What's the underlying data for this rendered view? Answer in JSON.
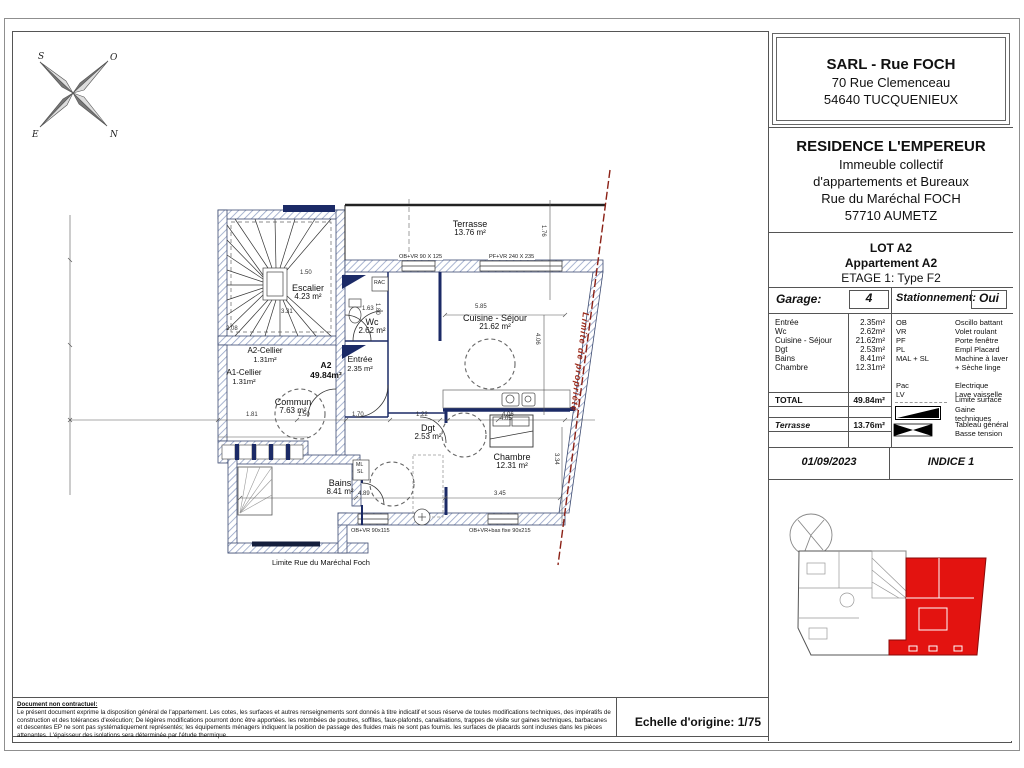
{
  "colors": {
    "key_red": "#e31310",
    "property_line": "#8b2015",
    "wall_hatch": "#94a3c6",
    "navy": "#1b2a66"
  },
  "compass": {
    "s": "S",
    "o": "O",
    "e": "E",
    "n": "N"
  },
  "title_block": {
    "company": {
      "name": "SARL - Rue FOCH",
      "address1": "70 Rue Clemenceau",
      "address2": "54640 TUCQUENIEUX"
    },
    "project": {
      "name": "RESIDENCE L'EMPEREUR",
      "line1": "Immeuble collectif",
      "line2": "d'appartements et Bureaux",
      "line3": "Rue du Maréchal FOCH",
      "line4": "57710 AUMETZ"
    },
    "lot": {
      "line1": "LOT A2",
      "line2": "Appartement  A2",
      "line3": "ETAGE 1: Type F2"
    },
    "garage": {
      "label": "Garage:",
      "value": "4"
    },
    "stationnement": {
      "label": "Stationnement:",
      "value": "Oui"
    },
    "rooms": [
      {
        "name": "Entrée",
        "area": "2.35m²"
      },
      {
        "name": "Wc",
        "area": "2.62m²"
      },
      {
        "name": "Cuisine - Séjour",
        "area": "21.62m²"
      },
      {
        "name": "Dgt",
        "area": "2.53m²"
      },
      {
        "name": "Bains",
        "area": "8.41m²"
      },
      {
        "name": "Chambre",
        "area": "12.31m²"
      }
    ],
    "legend": [
      {
        "abbr": "OB",
        "meaning": "Oscillo battant"
      },
      {
        "abbr": "VR",
        "meaning": "Volet roulant"
      },
      {
        "abbr": "PF",
        "meaning": "Porte fenêtre"
      },
      {
        "abbr": "PL",
        "meaning": "Empl Placard"
      },
      {
        "abbr": "MAL + SL",
        "meaning": "Machine à laver",
        "meaning2": "+ Sèche linge"
      },
      {
        "abbr": "Pac",
        "meaning": "Electrique"
      },
      {
        "abbr": "LV",
        "meaning": "Lave vaisselle"
      }
    ],
    "legend_symbols": {
      "limite": "Limite surface",
      "gaine": "Gaine techniques",
      "tableau_1": "Tableau général",
      "tableau_2": "Basse tension"
    },
    "total": {
      "label": "TOTAL",
      "value": "49.84m²"
    },
    "terrasse": {
      "label": "Terrasse",
      "value": "13.76m²"
    },
    "date": "01/09/2023",
    "indice": "INDICE 1"
  },
  "plan": {
    "rooms": [
      {
        "name": "Terrasse",
        "area": "13.76 m²"
      },
      {
        "name": "Escalier",
        "area": "4.23 m²"
      },
      {
        "name": "Wc",
        "area": "2.62 m²"
      },
      {
        "name": "Cuisine - Séjour",
        "area": "21.62 m²"
      },
      {
        "name": "A2-Cellier",
        "area": "1.31m²"
      },
      {
        "name": "A1-Cellier",
        "area": "1.31m²"
      },
      {
        "name": "Commun",
        "area": "7.63 m²"
      },
      {
        "name": "Entrée",
        "area": "2.35 m²"
      },
      {
        "name": "Dgt",
        "area": "2.53 m²"
      },
      {
        "name": "Chambre",
        "area": "12.31 m²"
      },
      {
        "name": "Bains",
        "area": "8.41 m²"
      }
    ],
    "unit_label": {
      "name": "A2",
      "area": "49.84m²"
    },
    "windows": [
      "OB+VR 90 X 125",
      "PF+VR 240 X 235",
      "OB+VR 90x115",
      "OB+VR+bas fixe 90x215"
    ],
    "boundaries": {
      "property": "Limite de propriété",
      "street": "Limite Rue du Maréchal Foch"
    },
    "dims": [
      "5.85",
      "1.63",
      "1.76",
      "4.06",
      "3.34",
      "1.81",
      "1.50",
      "1.70",
      "1.22",
      "4.06",
      "4.89",
      "3.45",
      "1.50",
      "3.31",
      "2.08",
      "4.05",
      "1.80"
    ],
    "misc": {
      "rac": "RAC",
      "ml": "ML",
      "sl": "SL"
    }
  },
  "footer": {
    "disclaimer_title": "Document non contractuel:",
    "disclaimer_line1": "Le présent document exprime la disposition général de l'appartement. Les cotes, les surfaces et autres renseignements sont donnés à titre indicatif et sous réserve de toutes modifications techniques, des impératifs de construction",
    "disclaimer_line2": "et des tolérances d'exécution; De légères modifications pourront donc être apportées. les retombées de poutres, soffites, faux-plafonds, canalisations, trappes de visite sur gaines techniques, barbacanes et descentes EP ne sont pas",
    "disclaimer_line3": "systématiquement représentés; les équipements ménagers indiquent la position de passage des fluides mais ne sont pas fournis. les surfaces de placards sont incluses dans les pièces attenantes. L'épaisseur des isolations sera déterminée par l'étude thermique.",
    "scale": "Echelle d'origine: 1/75"
  }
}
